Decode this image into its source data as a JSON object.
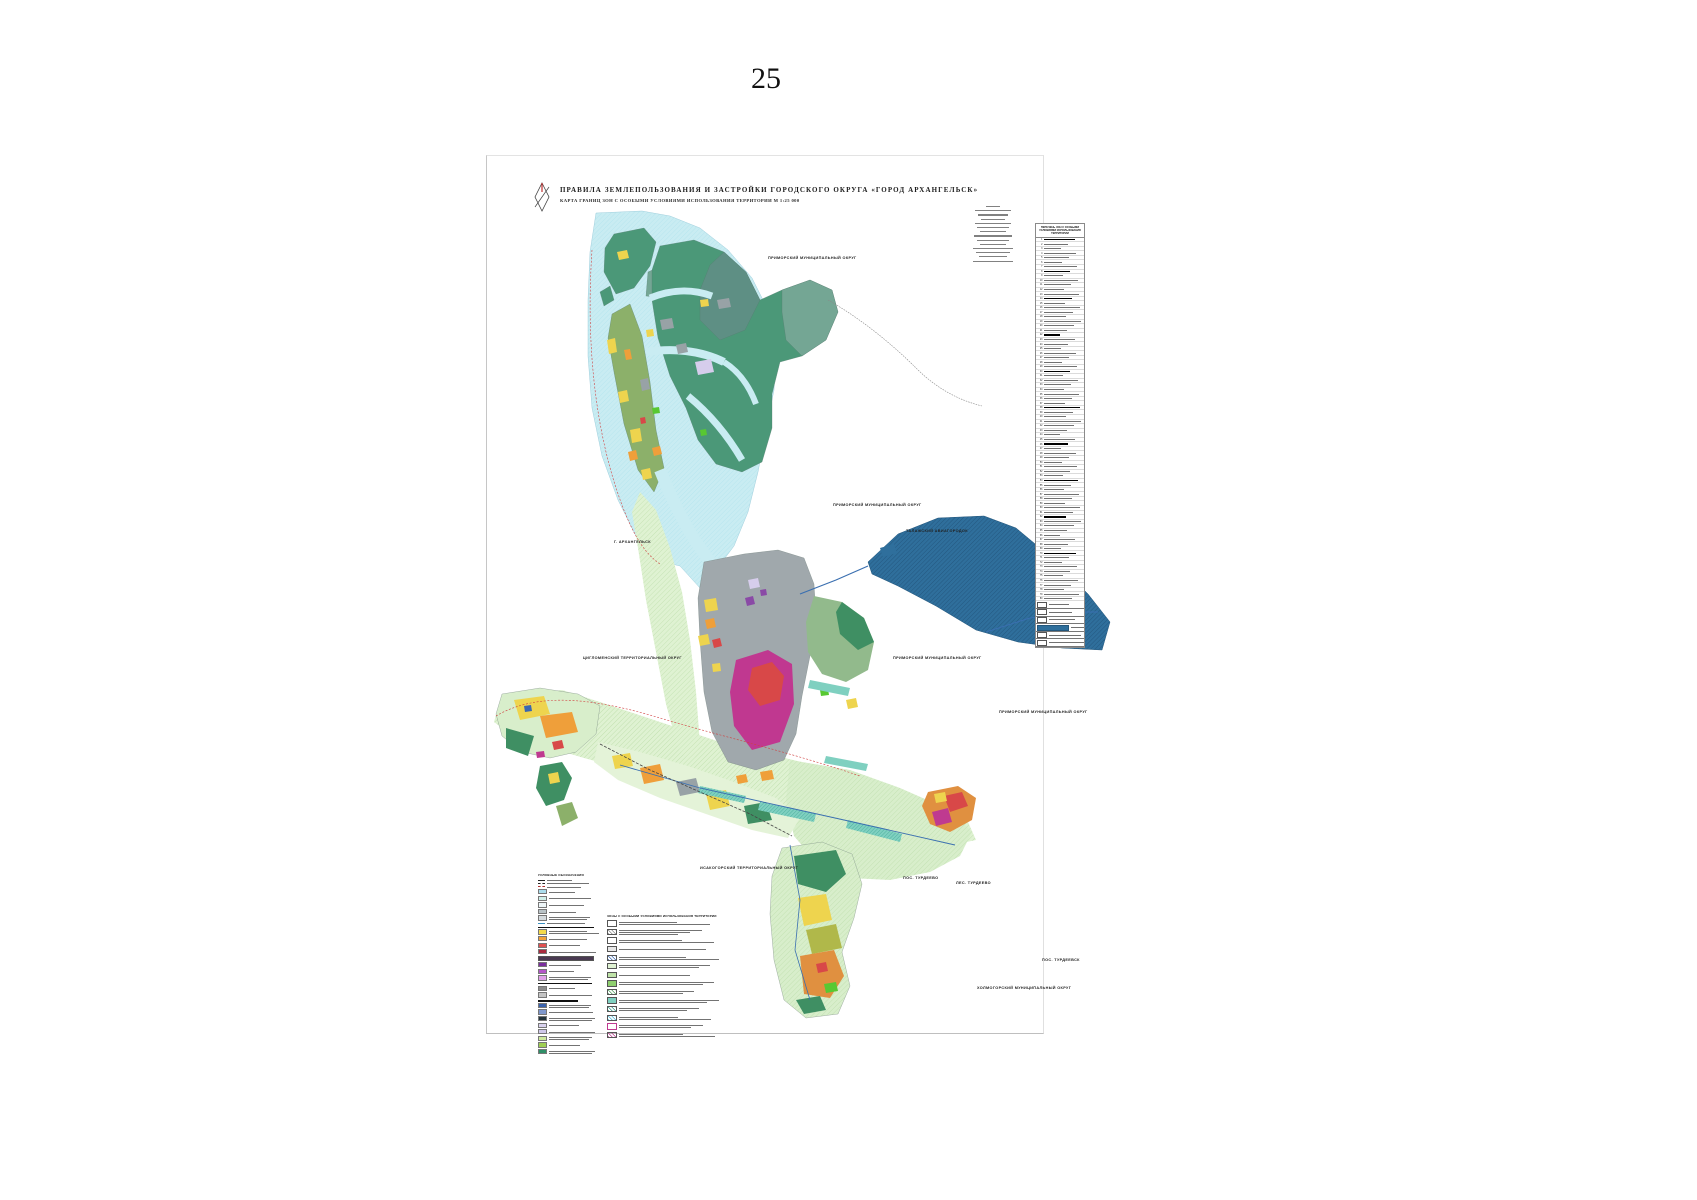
{
  "page_number": "25",
  "title_block": {
    "title": "ПРАВИЛА ЗЕМЛЕПОЛЬЗОВАНИЯ И ЗАСТРОЙКИ ГОРОДСКОГО ОКРУГА «ГОРОД АРХАНГЕЛЬСК»",
    "subtitle": "КАРТА ГРАНИЦ ЗОН С ОСОБЫМИ УСЛОВИЯМИ ИСПОЛЬЗОВАНИЯ ТЕРРИТОРИИ  М 1:25 000"
  },
  "notes": {
    "line_count": 14
  },
  "map_labels": [
    {
      "text": "ПРИМОРСКИЙ МУНИЦИПАЛЬНЫЙ ОКРУГ",
      "x": 768,
      "y": 256
    },
    {
      "text": "ПРИМОРСКИЙ МУНИЦИПАЛЬНЫЙ ОКРУГ",
      "x": 833,
      "y": 503
    },
    {
      "text": "ТАЛАЖСКИЙ АВИАГОРОДОК",
      "x": 906,
      "y": 529
    },
    {
      "text": "Г. АРХАНГЕЛЬСК",
      "x": 614,
      "y": 540
    },
    {
      "text": "ЦИГЛОМЕНСКИЙ ТЕРРИТОРИАЛЬНЫЙ ОКРУГ",
      "x": 583,
      "y": 656
    },
    {
      "text": "ПРИМОРСКИЙ МУНИЦИПАЛЬНЫЙ ОКРУГ",
      "x": 893,
      "y": 656
    },
    {
      "text": "ПРИМОРСКИЙ МУНИЦИПАЛЬНЫЙ ОКРУГ",
      "x": 999,
      "y": 710
    },
    {
      "text": "ИСАКОГОРСКИЙ ТЕРРИТОРИАЛЬНЫЙ ОКРУГ",
      "x": 700,
      "y": 866
    },
    {
      "text": "ПОС. ТУРДЕЕВО",
      "x": 903,
      "y": 876
    },
    {
      "text": "ЛЕС. ТУРДЕЕВО",
      "x": 956,
      "y": 881
    },
    {
      "text": "ПОС. ТУРДЕЕВСК",
      "x": 1042,
      "y": 958
    },
    {
      "text": "ХОЛМОГОРСКИЙ МУНИЦИПАЛЬНЫЙ ОКРУГ",
      "x": 977,
      "y": 986
    }
  ],
  "legend_left": {
    "title": "УСЛОВНЫЕ ОБОЗНАЧЕНИЯ",
    "rows": [
      {
        "t": "line",
        "c": "#222222",
        "s": "solid"
      },
      {
        "t": "line",
        "c": "#222222",
        "s": "dashed"
      },
      {
        "t": "line",
        "c": "#b03030",
        "s": "dashed"
      },
      {
        "t": "swatch",
        "c": "#aadcec"
      },
      {
        "t": "swatch",
        "c": "#cfefe9"
      },
      {
        "t": "swatch",
        "c": "#eef6f8"
      },
      {
        "t": "swatch",
        "c": "#b9c3c7"
      },
      {
        "t": "swatch",
        "c": "#d4dadd",
        "l": 2
      },
      {
        "t": "line",
        "c": "#3a8fc0",
        "s": "solid"
      },
      {
        "t": "header"
      },
      {
        "t": "swatch",
        "c": "#f3d94b",
        "l": 2
      },
      {
        "t": "swatch",
        "c": "#f0a13b"
      },
      {
        "t": "swatch",
        "c": "#e05050"
      },
      {
        "t": "swatch",
        "c": "#a92c3f"
      },
      {
        "t": "wide",
        "c": "#4a3a52"
      },
      {
        "t": "swatch",
        "c": "#7b2f9e"
      },
      {
        "t": "swatch",
        "c": "#b455c8"
      },
      {
        "t": "swatch",
        "c": "#e0a0e8",
        "l": 2
      },
      {
        "t": "header"
      },
      {
        "t": "swatch",
        "c": "#8d8d8d"
      },
      {
        "t": "swatch",
        "c": "#c4c4c4"
      },
      {
        "t": "header"
      },
      {
        "t": "swatch",
        "c": "#3b63ae",
        "l": 2
      },
      {
        "t": "swatch",
        "c": "#7e97cc"
      },
      {
        "t": "swatch",
        "c": "#22333b",
        "l": 2
      },
      {
        "t": "swatch",
        "c": "#d9d2ee"
      },
      {
        "t": "swatch",
        "c": "#cfc8ea"
      },
      {
        "t": "swatch",
        "c": "#cde99e",
        "l": 2
      },
      {
        "t": "swatch",
        "c": "#9fcf53"
      },
      {
        "t": "swatch",
        "c": "#2f8f68",
        "l": 2
      }
    ]
  },
  "legend_right": {
    "title": "ЗОНЫ С ОСОБЫМИ УСЛОВИЯМИ ИСПОЛЬЗОВАНИЯ ТЕРРИТОРИИ",
    "rows": [
      {
        "p": "outline",
        "c": "#555555",
        "l": 2
      },
      {
        "p": "hatch",
        "c": "#888888",
        "l": 3
      },
      {
        "p": "outline",
        "c": "#555555",
        "l": 2
      },
      {
        "p": "solid",
        "c": "#e8e8e8",
        "l": 1
      },
      {
        "p": "hatch",
        "c": "#3a66b0",
        "l": 2
      },
      {
        "p": "solid",
        "c": "#dff2d2",
        "l": 2
      },
      {
        "p": "solid",
        "c": "#bfe3a8",
        "l": 1
      },
      {
        "p": "solid",
        "c": "#8fcf6f",
        "l": 2
      },
      {
        "p": "hatch",
        "c": "#4f9e5e",
        "l": 2
      },
      {
        "p": "solid",
        "c": "#7fd0c0",
        "l": 2
      },
      {
        "p": "hatch",
        "c": "#2f9c8a",
        "l": 2
      },
      {
        "p": "hatch",
        "c": "#49b8d8",
        "l": 2
      },
      {
        "p": "outline",
        "c": "#bf3a90",
        "l": 2
      },
      {
        "p": "hatch",
        "c": "#bf3a90",
        "l": 2
      }
    ]
  },
  "zone_table": {
    "title": "ПЕРЕЧЕНЬ ЗОН С ОСОБЫМИ УСЛОВИЯМИ ИСПОЛЬЗОВАНИЯ ТЕРРИТОРИИ",
    "row_count": 80,
    "section_rows": [
      1,
      8,
      14,
      22,
      30,
      38,
      46,
      54,
      62,
      70
    ],
    "boxed_rows": [
      {
        "highlight": false
      },
      {
        "highlight": false
      },
      {
        "highlight": false
      },
      {
        "highlight": true
      },
      {
        "highlight": false
      },
      {
        "highlight": false
      }
    ]
  },
  "palette": {
    "water": "#c9ecf2",
    "forest_green": "#4b9878",
    "pale_farmland": "#dff2d2",
    "residential_yellow": "#eed44e",
    "business_orange": "#ef9f3a",
    "dense_red": "#d84848",
    "core_magenta": "#c03890",
    "industrial_gray": "#a0a8ac",
    "airport_navy": "#2f6f9c",
    "special_teal": "#7fd0c0",
    "road_blue": "#3a6fb0",
    "boundary_red": "#d04040"
  }
}
